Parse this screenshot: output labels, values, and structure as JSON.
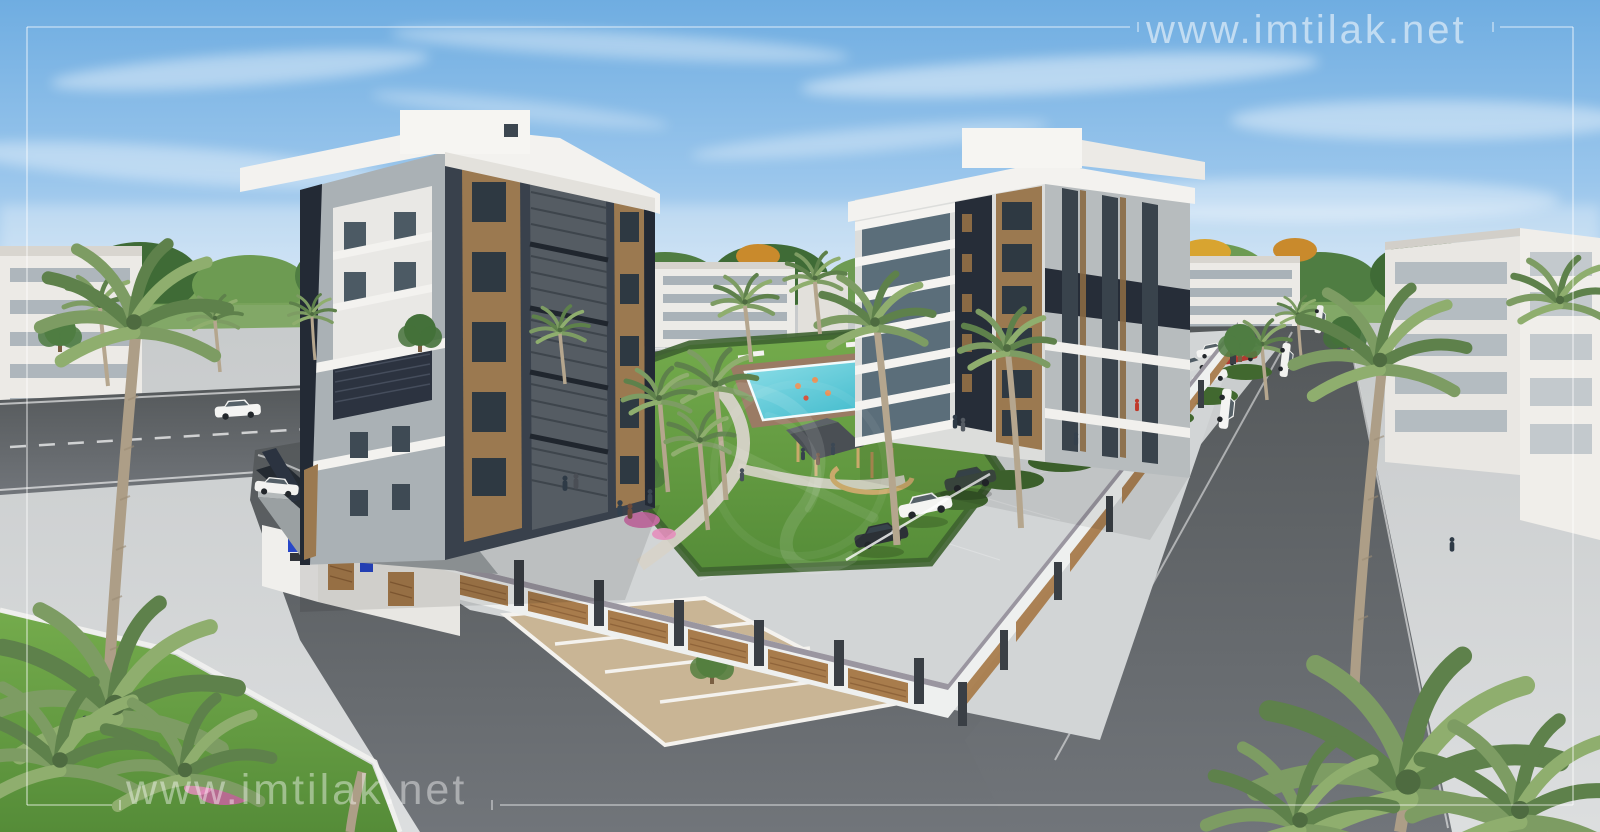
{
  "meta": {
    "type": "3d-architectural-render",
    "subject": "Aerial render of a gated residential compound: two modern apartment blocks, swimming pool garden with gazebo, parking, perimeter fence and palm-lined streets"
  },
  "watermark": {
    "url_text": "www.imtilak.net",
    "logo": "imtilak-calligraphy-watermark",
    "color": "#ffffff",
    "top_right_opacity": 0.55,
    "bottom_left_opacity": 0.42
  },
  "frame": {
    "color": "#ffffff",
    "opacity": 0.5,
    "inset_px": 27
  },
  "palette": {
    "sky_top": "#6fade1",
    "sky_horizon": "#e9f1f8",
    "asphalt": "#606466",
    "plaza_pavers": "#ced1d2",
    "sidewalk": "#d8d4ca",
    "lawn": "#64a044",
    "hedge": "#41682f",
    "pool_water": "#55c8d8",
    "building_dark_panel": "#262d38",
    "building_gray": "#b4babd",
    "building_white": "#f1f0ec",
    "brick_accent": "#9b7950",
    "fence_wood": "#a87c4c",
    "gravel_parking": "#c9b595"
  }
}
